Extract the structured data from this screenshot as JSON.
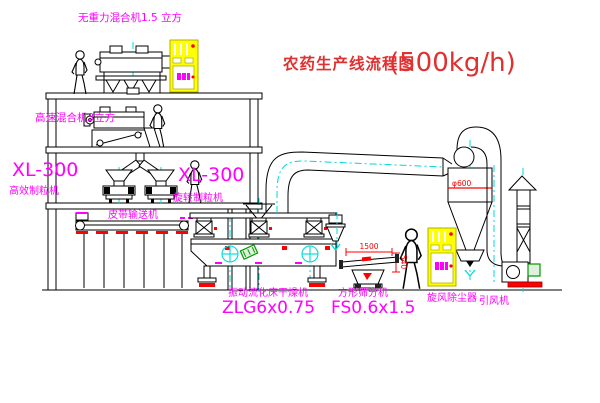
{
  "meta": {
    "width": 600,
    "height": 403,
    "background": "#ffffff"
  },
  "colors": {
    "label_magenta": "#ff00ff",
    "title_red": "#e03030",
    "dimension_red": "#ff0000",
    "line_black": "#000000",
    "centerline_cyan": "#00d8d8",
    "cabinet_yellow": "#ffff00",
    "motor_green": "#009900"
  },
  "title": {
    "cn": "农药生产线流程图",
    "capacity": "(500kg/h)"
  },
  "labels": {
    "top_mixer": "无重力混合机1.5 立方",
    "hs_mixer": "高速混合机3立方",
    "xl_left_model": "XL-300",
    "xl_left_name": "高效制粒机",
    "xl_right_model": "XL-300",
    "xl_right_name": "旋转制粒机",
    "belt": "皮带输送机",
    "dryer_name": "振动流化床干燥机",
    "dryer_model": "ZLG6x0.75",
    "sieve_name": "方形筛分机",
    "sieve_model": "FS0.6x1.5",
    "cyclone": "旋风除尘器",
    "fan": "引风机",
    "dim_length": "1500",
    "dim_height": "540",
    "dim_diameter": "φ600"
  }
}
